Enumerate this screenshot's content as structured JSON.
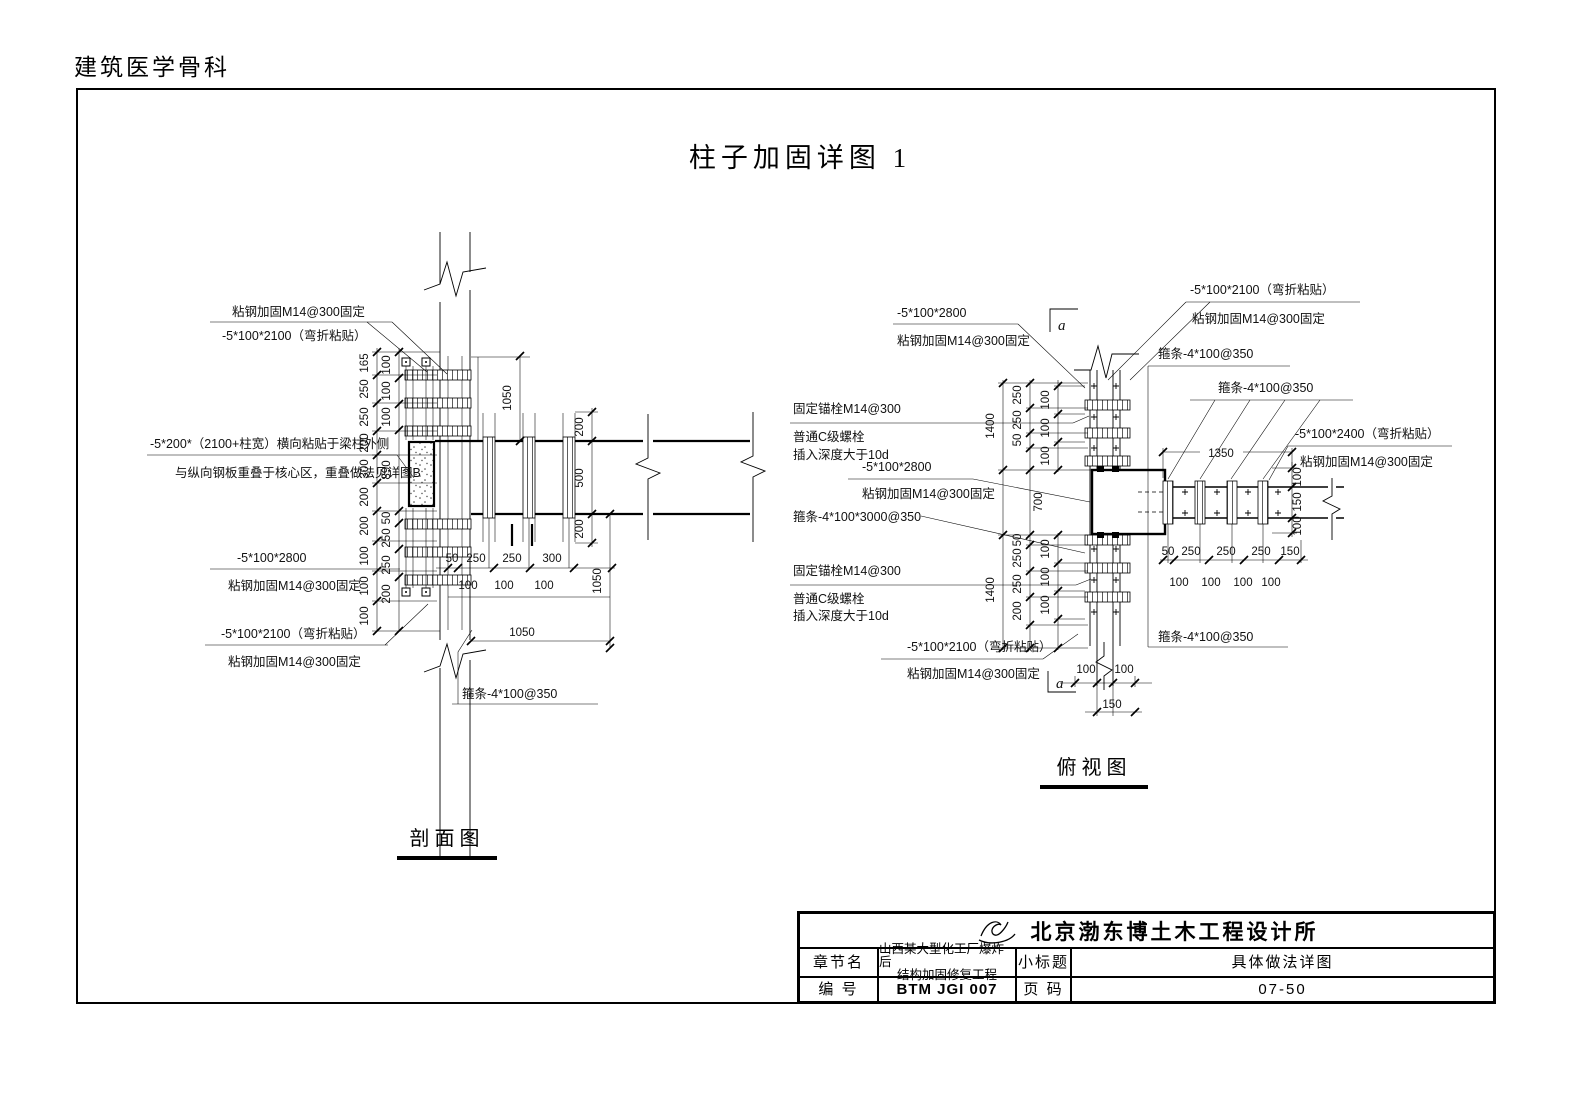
{
  "page": {
    "header": "建筑医学骨科",
    "title": "柱子加固详图 1"
  },
  "section_view": {
    "caption": "剖面图",
    "ann": {
      "top1": "粘钢加固M14@300固定",
      "top2": "-5*100*2100（弯折粘贴）",
      "side1": "-5*200*（2100+柱宽）横向粘贴于梁柱外侧",
      "side2": "与纵向钢板重叠于核心区，重叠做法见详图B",
      "low1a": "-5*100*2800",
      "low1b": "粘钢加固M14@300固定",
      "low2a": "-5*100*2100（弯折粘贴）",
      "low2b": "粘钢加固M14@300固定",
      "hoop": "箍条-4*100@350"
    },
    "dims": {
      "upper_outer": [
        "165",
        "250",
        "250",
        "200",
        "300",
        "200"
      ],
      "upper_inner": [
        "100",
        "100",
        "100",
        "890"
      ],
      "lower_outer": [
        "200",
        "100",
        "100",
        "100"
      ],
      "lower_inner": [
        "50",
        "250",
        "250",
        "200"
      ],
      "right_chain": [
        "200",
        "500",
        "200"
      ],
      "v_top": "1050",
      "v_bot": "1050",
      "bot_chain": [
        "50",
        "250",
        "250",
        "300"
      ],
      "bot_chain2": [
        "100",
        "100",
        "100"
      ],
      "bot_total": "1050"
    }
  },
  "plan_view": {
    "caption": "俯视图",
    "ann": {
      "tl1": "-5*100*2800",
      "tl2": "粘钢加固M14@300固定",
      "tr1": "-5*100*2100（弯折粘贴）",
      "tr2": "粘钢加固M14@300固定",
      "hoop_top": "箍条-4*100@350",
      "hoop_fan": "箍条-4*100@350",
      "hoop_bot": "箍条-4*100@350",
      "hoop_mid": "箍条-4*100*3000@350",
      "r1": "-5*100*2400（弯折粘贴）",
      "r2": "粘钢加固M14@300固定",
      "ml1": "固定锚栓M14@300",
      "ml2": "普通C级螺栓",
      "ml3": "插入深度大于10d",
      "mc1": "-5*100*2800",
      "mc2": "粘钢加固M14@300固定",
      "ll1": "固定锚栓M14@300",
      "ll2": "普通C级螺栓",
      "ll3": "插入深度大于10d",
      "bot1": "-5*100*2100（弯折粘贴）",
      "bot2": "粘钢加固M14@300固定",
      "marker_a": "a"
    },
    "dims": {
      "left_outer": [
        "1400",
        "1400"
      ],
      "mid_top": [
        "250",
        "250",
        "50"
      ],
      "joint": "700",
      "mid_bot": [
        "50",
        "250",
        "250",
        "200"
      ],
      "inner_top": [
        "100",
        "100",
        "100"
      ],
      "inner_bot": [
        "100",
        "100",
        "100"
      ],
      "beam_total": "1350",
      "right_chain": [
        "100",
        "150",
        "100"
      ],
      "bot_chain": [
        "50",
        "250",
        "250",
        "250",
        "150"
      ],
      "bot_chain2": [
        "100",
        "100",
        "100",
        "100"
      ],
      "col_bot": [
        "100",
        "100"
      ],
      "col_total": "150"
    }
  },
  "title_block": {
    "company": "北京渤东博土木工程设计所",
    "row2": {
      "k1": "章节名",
      "v1a": "山西某大型化工厂爆炸后",
      "v1b": "结构加固修复工程",
      "k2": "小标题",
      "v2": "具体做法详图"
    },
    "row3": {
      "k1": "编  号",
      "v1": "BTM JGI 007",
      "k2": "页  码",
      "v2": "07-50"
    }
  }
}
